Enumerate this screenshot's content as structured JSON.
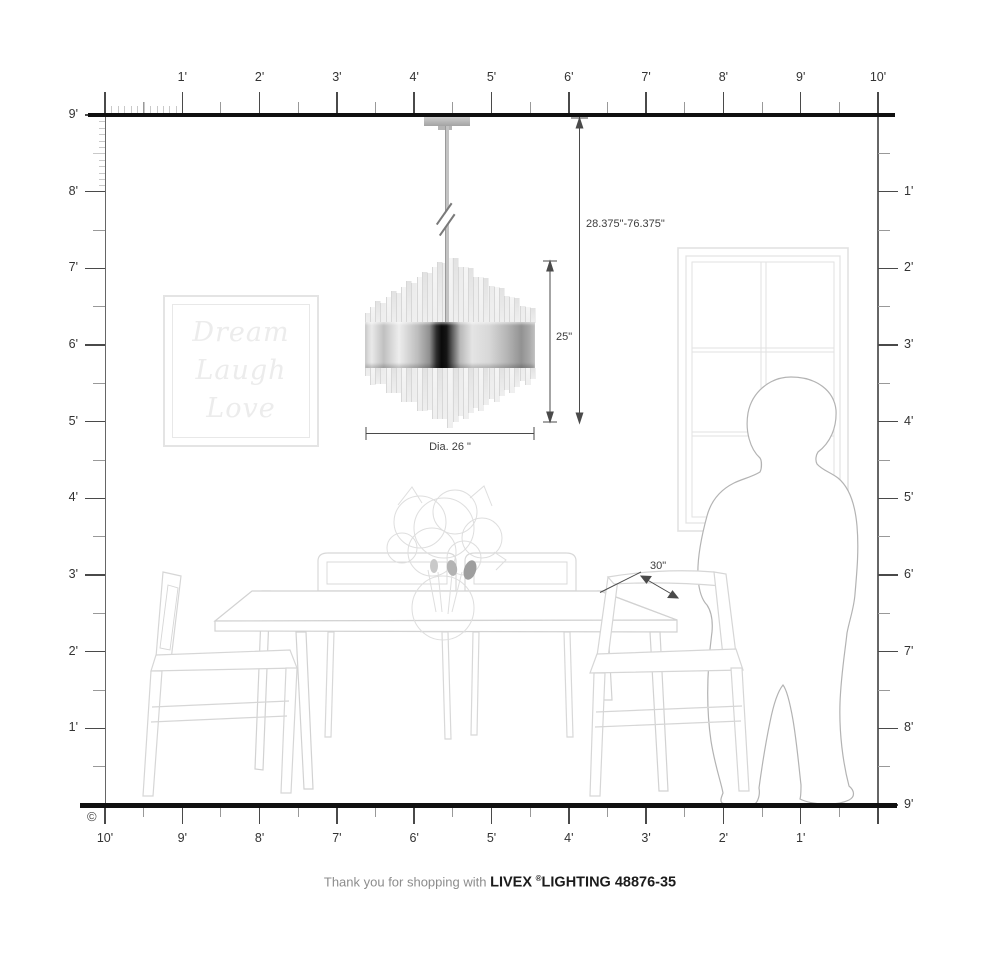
{
  "rulers": {
    "top": {
      "labels": [
        "1'",
        "2'",
        "3'",
        "4'",
        "5'",
        "6'",
        "7'",
        "8'",
        "9'",
        "10'"
      ]
    },
    "left": {
      "labels": [
        "9'",
        "8'",
        "7'",
        "6'",
        "5'",
        "4'",
        "3'",
        "2'",
        "1'"
      ]
    },
    "right": {
      "labels": [
        "1'",
        "2'",
        "3'",
        "4'",
        "5'",
        "6'",
        "7'",
        "8'",
        "9'"
      ]
    },
    "bottom": {
      "labels": [
        "10'",
        "9'",
        "8'",
        "7'",
        "6'",
        "5'",
        "4'",
        "3'",
        "2'",
        "1'"
      ]
    }
  },
  "dimensions": {
    "hang_range": "28.375\"-76.375\"",
    "fixture_height": "25\"",
    "diameter": "Dia. 26 \"",
    "table_depth": "30\""
  },
  "wall_art": {
    "lines": [
      "Dream",
      "Laugh",
      "Love"
    ]
  },
  "footer": {
    "prefix": "Thank you for shopping with",
    "brand": "LIVEX",
    "registered": "®",
    "model": "LIGHTING 48876-35"
  },
  "copyright_symbol": "©",
  "colors": {
    "structure": "#101010",
    "ruler": "#4a4a4a",
    "lineart": "#d6d6d6",
    "silhouette": "#b3b3b3",
    "accent_dark_band": "#0a0a0a"
  }
}
